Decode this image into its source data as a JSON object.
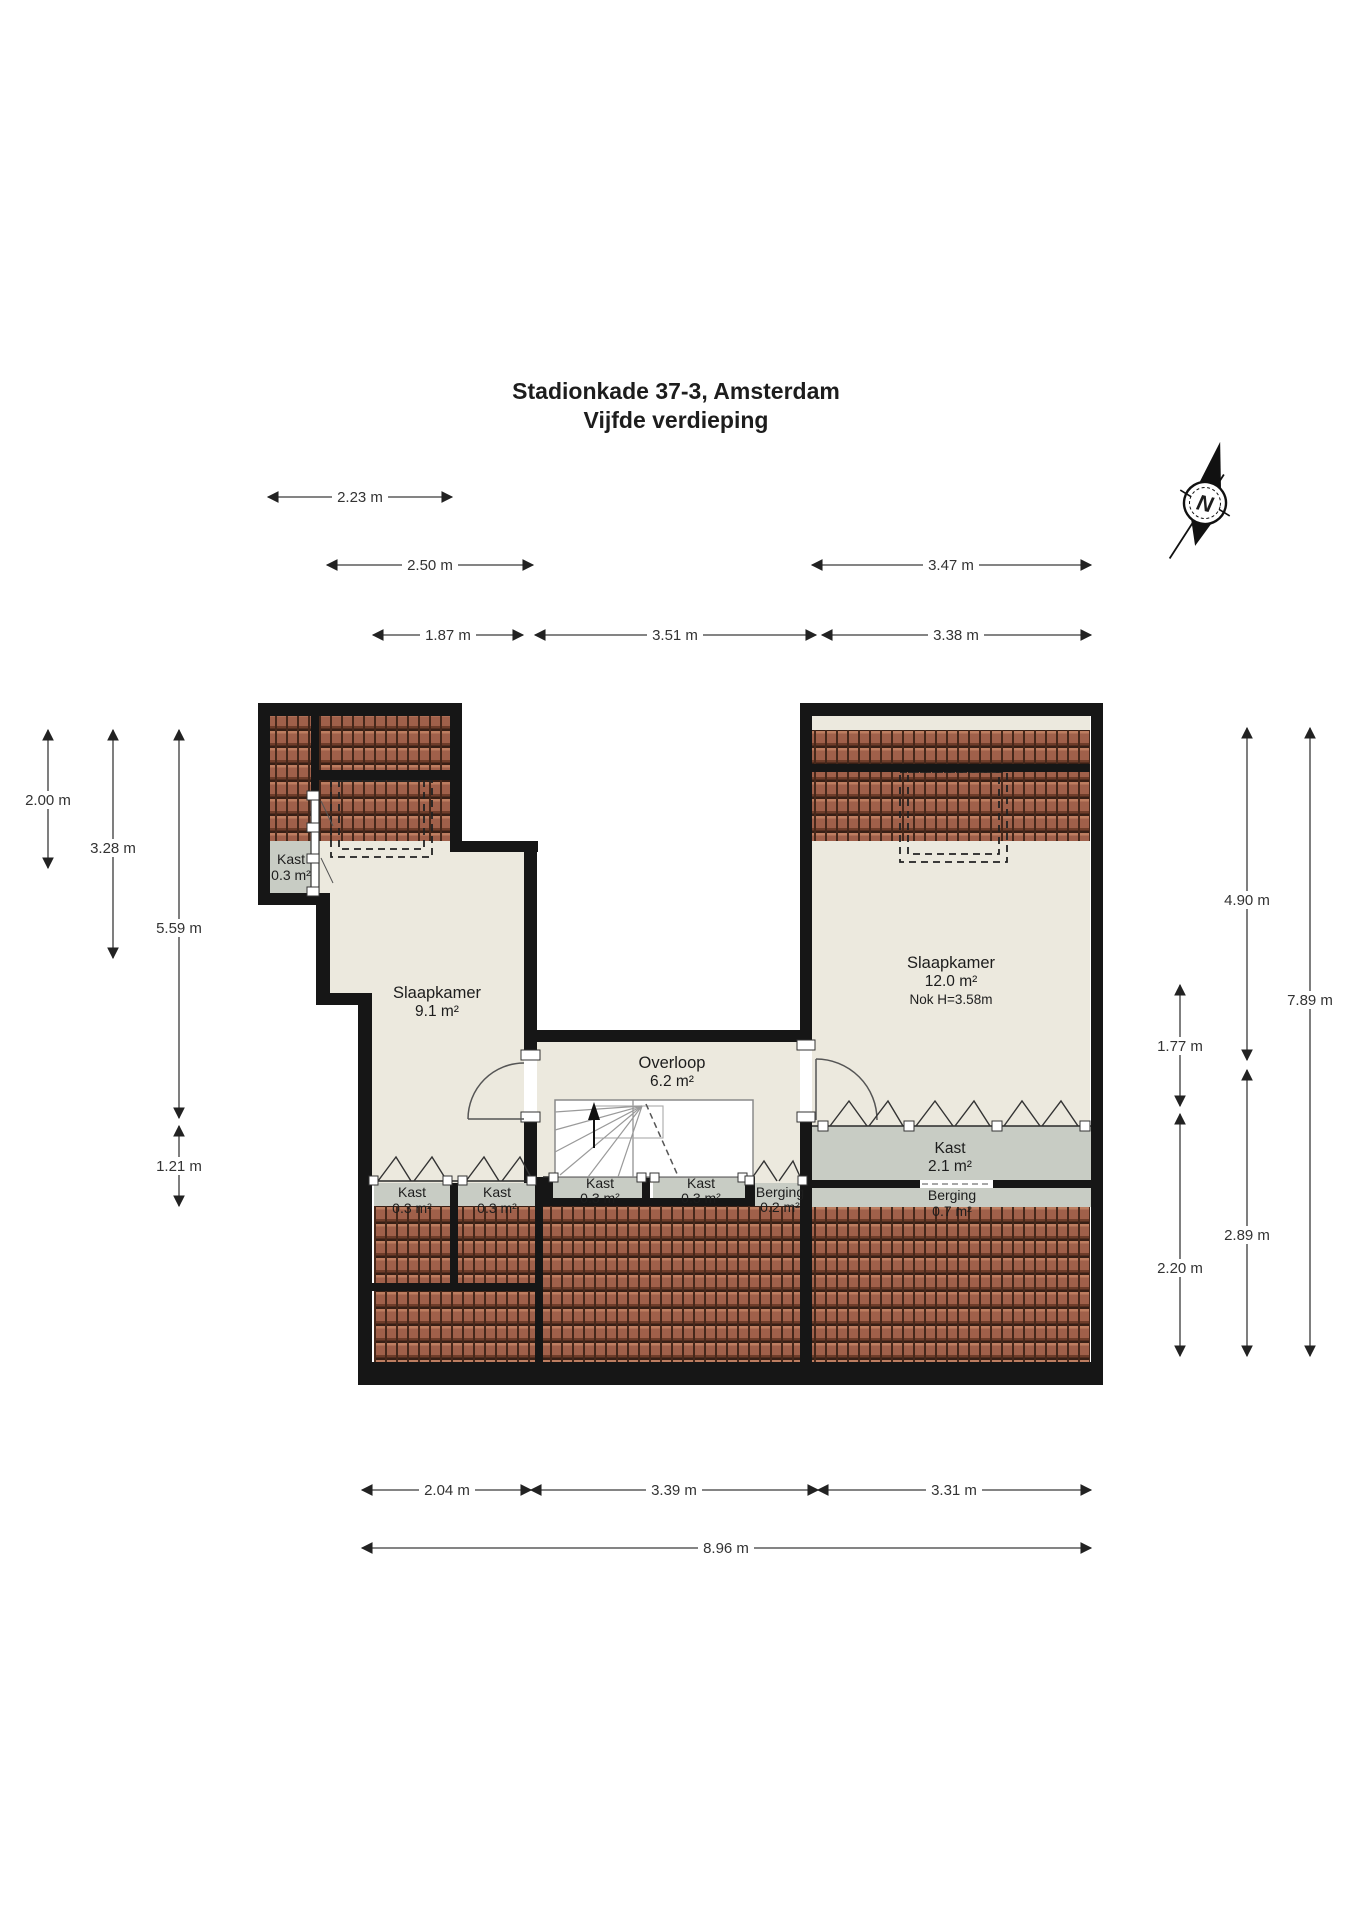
{
  "title": {
    "line1": "Stadionkade 37-3, Amsterdam",
    "line2": "Vijfde verdieping"
  },
  "compass": {
    "north_label": "N"
  },
  "rooms": {
    "slaapkamer_left": {
      "name": "Slaapkamer",
      "area": "9.1 m²"
    },
    "slaapkamer_right": {
      "name": "Slaapkamer",
      "area": "12.0 m²",
      "note": "Nok H=3.58m"
    },
    "overloop": {
      "name": "Overloop",
      "area": "6.2 m²"
    },
    "kast_topleft": {
      "name": "Kast",
      "area": "0.3 m²"
    },
    "kast_a": {
      "name": "Kast",
      "area": "0.3 m²"
    },
    "kast_b": {
      "name": "Kast",
      "area": "0.3 m²"
    },
    "kast_c": {
      "name": "Kast",
      "area": "0.3 m²"
    },
    "kast_d": {
      "name": "Kast",
      "area": "0.3 m²"
    },
    "kast_wide": {
      "name": "Kast",
      "area": "2.1 m²"
    },
    "berging_small": {
      "name": "Berging",
      "area": "0.2 m²"
    },
    "berging_right": {
      "name": "Berging",
      "area": "0.7 m²"
    }
  },
  "dims": {
    "d223": "2.23 m",
    "d250": "2.50 m",
    "d347": "3.47 m",
    "d187": "1.87 m",
    "d351": "3.51 m",
    "d338": "3.38 m",
    "d200": "2.00 m",
    "d328": "3.28 m",
    "d559": "5.59 m",
    "d121": "1.21 m",
    "d490": "4.90 m",
    "d789": "7.89 m",
    "d177": "1.77 m",
    "d289": "2.89 m",
    "d220": "2.20 m",
    "d204": "2.04 m",
    "d339": "3.39 m",
    "d331": "3.31 m",
    "d896": "8.96 m"
  },
  "colors": {
    "wall": "#161616",
    "floor_cream": "#ece9de",
    "floor_grey": "#c8ccc4",
    "tile_base": "#a0604a",
    "tile_dark": "#3f241a"
  }
}
